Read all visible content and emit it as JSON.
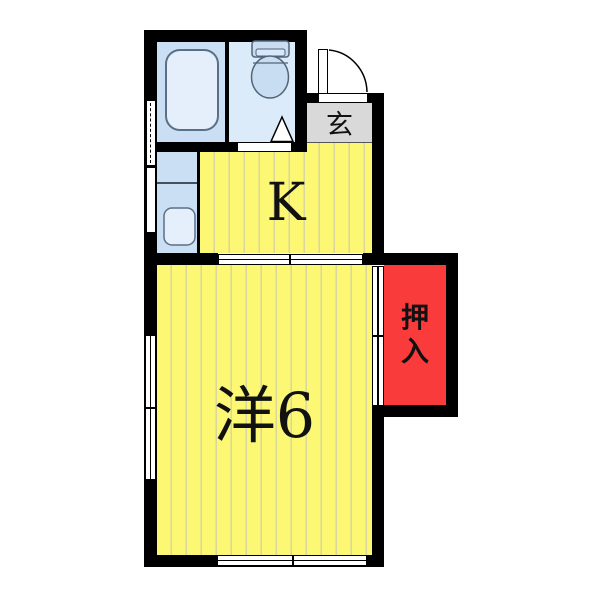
{
  "plan": {
    "type": "japanese-apartment-floorplan",
    "rooms": {
      "kitchen": {
        "label": "K"
      },
      "entrance": {
        "label": "玄"
      },
      "western_room": {
        "label": "洋6"
      },
      "closet": {
        "label": "押入",
        "chars": [
          "押",
          "入"
        ]
      }
    },
    "fixtures": [
      "bathtub",
      "toilet",
      "kitchen-sink",
      "entrance-door",
      "sliding-doors",
      "windows"
    ]
  },
  "colors": {
    "wall": "#000000",
    "room_yellow": "#FCF873",
    "stripe_olive": "#D9D6A1",
    "bathroom_blue": "#CBDFF4",
    "toilet_blue": "#DCEBFA",
    "fixture_blue": "#E4EFFB",
    "fixture_stroke": "#5A7086",
    "closet_red": "#F93B3B",
    "entrance_gray": "#D9D9D9",
    "symbol_white": "#FFFFFF",
    "label_black": "#111111"
  }
}
